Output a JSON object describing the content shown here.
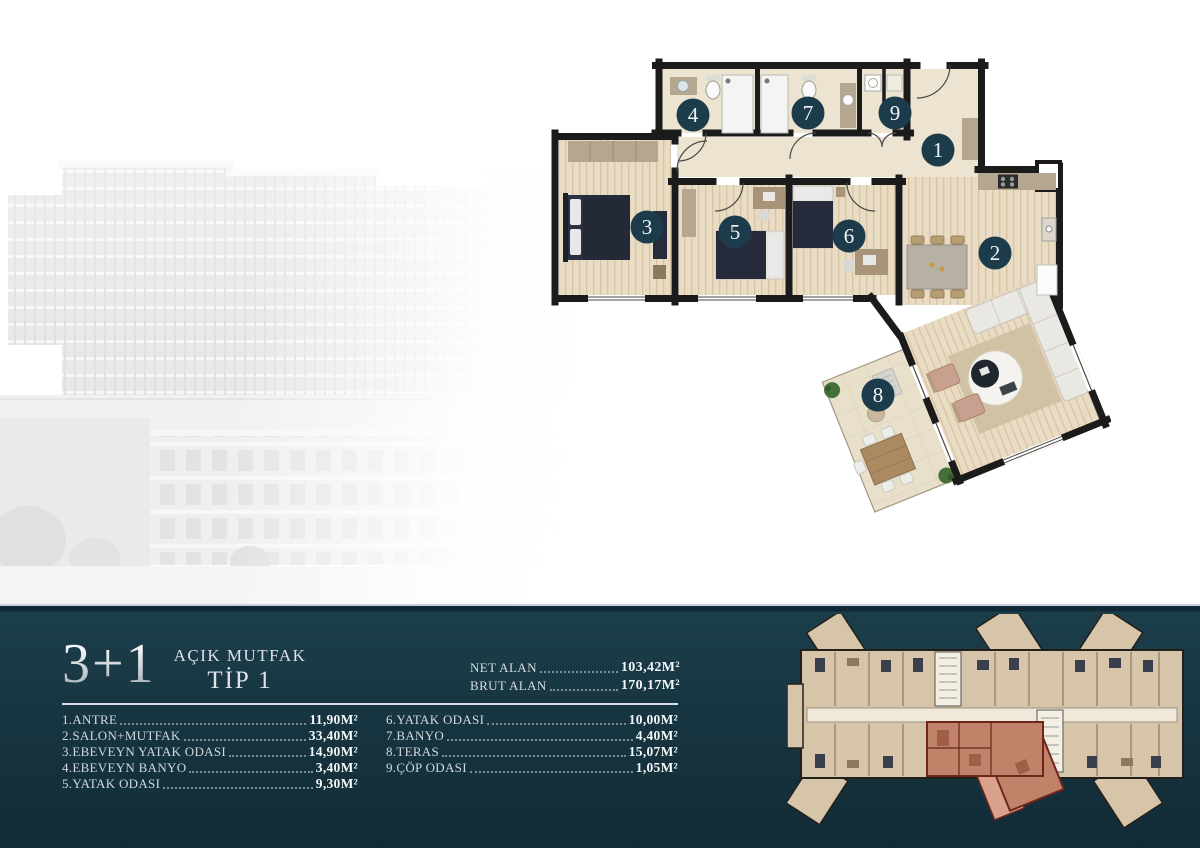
{
  "band": {
    "unit_type": "3+1",
    "title_line1": "AÇIK MUTFAK",
    "title_line2": "TİP 1",
    "net": {
      "label": "NET ALAN",
      "value": "103,42M²"
    },
    "brut": {
      "label": "BRUT ALAN",
      "value": "170,17M²"
    }
  },
  "room_list": {
    "column1": [
      {
        "name": "1.ANTRE",
        "area": "11,90M²"
      },
      {
        "name": "2.SALON+MUTFAK",
        "area": "33,40M²"
      },
      {
        "name": "3.EBEVEYN YATAK ODASI",
        "area": "14,90M²"
      },
      {
        "name": "4.EBEVEYN BANYO",
        "area": "3,40M²"
      },
      {
        "name": "5.YATAK ODASI",
        "area": "9,30M²"
      }
    ],
    "column2": [
      {
        "name": "6.YATAK ODASI",
        "area": "10,00M²"
      },
      {
        "name": "7.BANYO",
        "area": "4,40M²"
      },
      {
        "name": "8.TERAS",
        "area": "15,07M²"
      },
      {
        "name": "9.ÇÖP ODASI",
        "area": "1,05M²"
      }
    ]
  },
  "floor_plan": {
    "badges": [
      {
        "num": "1",
        "x": 387,
        "y": 97
      },
      {
        "num": "2",
        "x": 444,
        "y": 200
      },
      {
        "num": "3",
        "x": 96,
        "y": 174
      },
      {
        "num": "4",
        "x": 142,
        "y": 62
      },
      {
        "num": "5",
        "x": 184,
        "y": 179
      },
      {
        "num": "6",
        "x": 298,
        "y": 183
      },
      {
        "num": "7",
        "x": 257,
        "y": 60
      },
      {
        "num": "8",
        "x": 327,
        "y": 342
      },
      {
        "num": "9",
        "x": 344,
        "y": 60
      }
    ]
  },
  "colors": {
    "band_bg": "#15323d",
    "badge": "#1d3c4b",
    "wall": "#1b1b1b",
    "floor_beige": "#ece4d1",
    "floor_wood": "#e9dcc5",
    "cabinet_tan": "#b5a78f",
    "key_highlight": "#c08268",
    "key_highlight_terrace": "#d8a28d"
  }
}
